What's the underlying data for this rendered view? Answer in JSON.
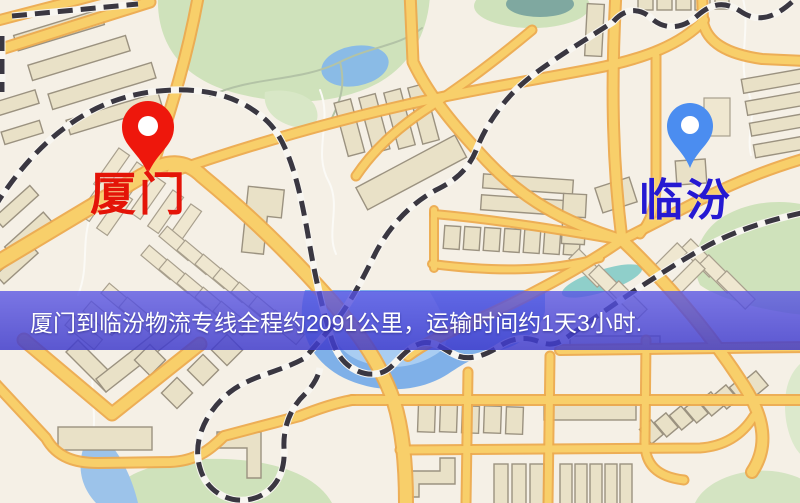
{
  "banner": {
    "text": "厦门到临汾物流专线全程约2091公里，运输时间约1天3小时.",
    "background_color": "#4c48d9",
    "text_color": "#ffffff"
  },
  "markers": {
    "origin": {
      "label": "厦门",
      "label_color": "#e41408",
      "pin_color": "#ee170c"
    },
    "destination": {
      "label": "临汾",
      "label_color": "#2519d2",
      "pin_color": "#4b8df0"
    }
  },
  "route": {
    "distance_text": "约2091公里",
    "duration_text": "约1天3小时"
  },
  "map_palette": {
    "background": "#f5f0e6",
    "road_fill": "#f8cf6a",
    "road_casing": "#ecaa4e",
    "building_fill": "#e9e1c7",
    "building_stroke": "#9b9280",
    "park_green": "#cfe2bb",
    "water_blue": "#7fb0e8",
    "railway_dark": "#3a3741"
  }
}
